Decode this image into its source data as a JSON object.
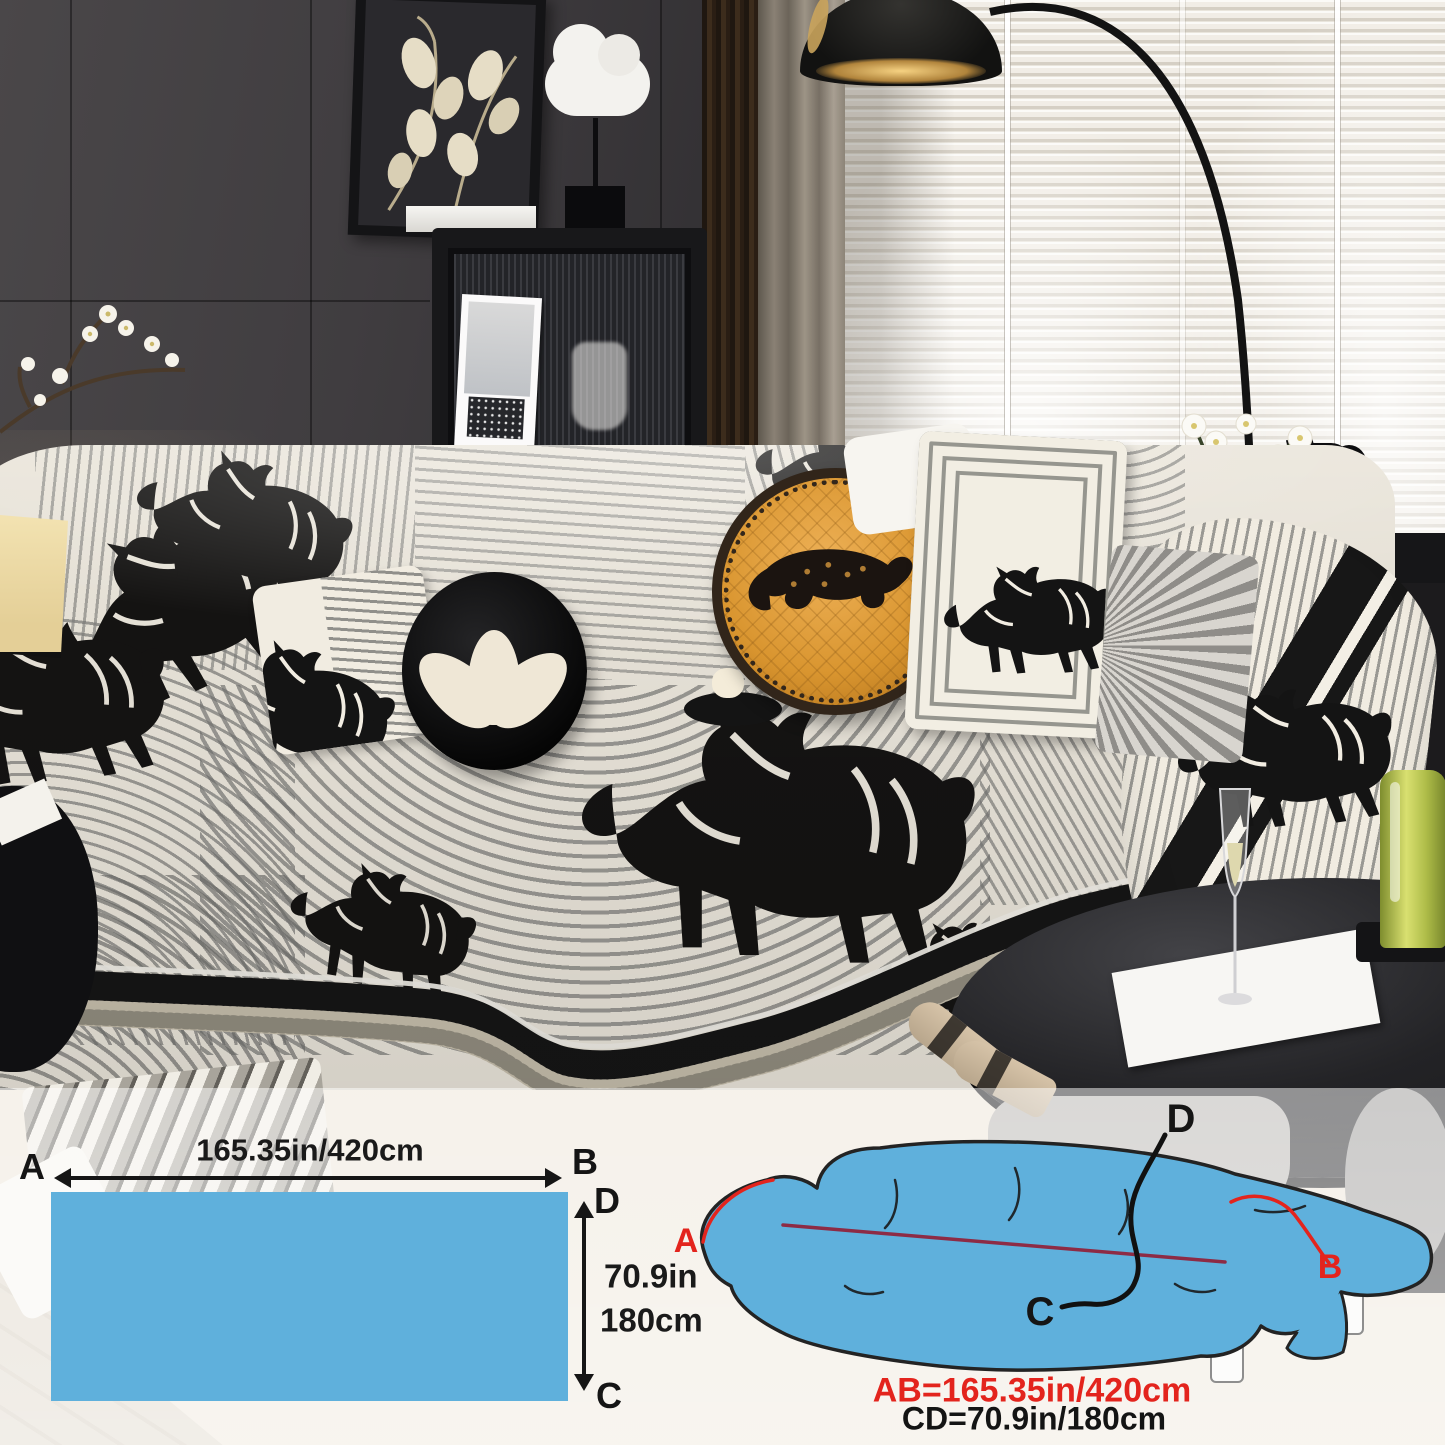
{
  "flat_diagram": {
    "width_label": "165.35in/420cm",
    "height_label_line1": "70.9in",
    "height_label_line2": "180cm",
    "corner_a": "A",
    "corner_b": "B",
    "corner_c": "C",
    "corner_d": "D"
  },
  "sofa_diagram": {
    "point_a": "A",
    "point_b": "B",
    "point_c": "C",
    "point_d": "D",
    "ab_measurement": "AB=165.35in/420cm",
    "cd_measurement": "CD=70.9in/180cm"
  },
  "colors": {
    "fabric_swatch_blue": "#5FB0DC",
    "accent_red": "#E3241D",
    "measure_line_dark_red": "#8D2B45",
    "ink_black": "#161616"
  }
}
